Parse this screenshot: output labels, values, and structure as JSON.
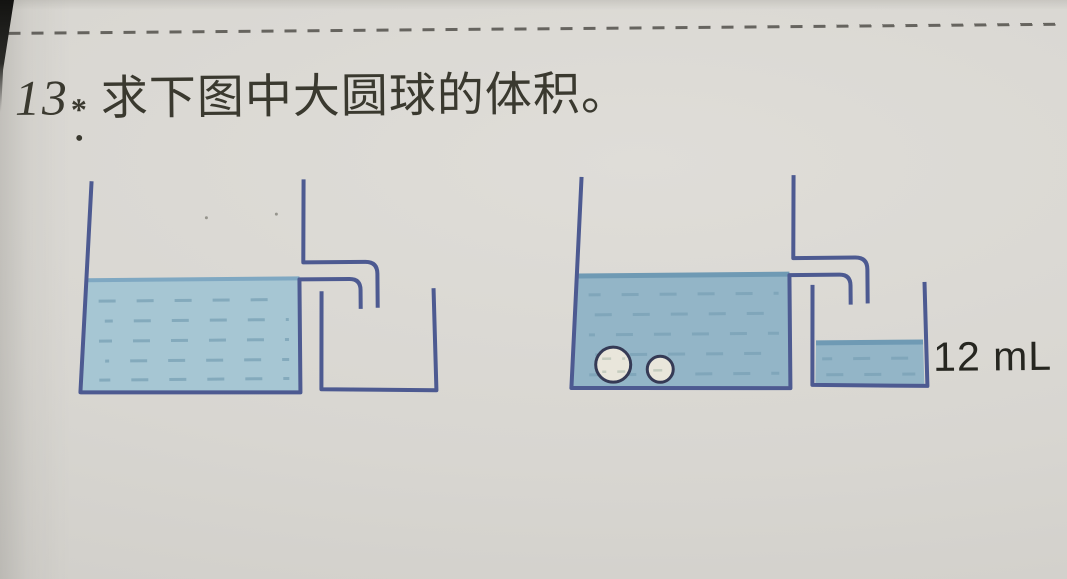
{
  "problem": {
    "number": "13",
    "star": "*",
    "dot": ".",
    "text": "求下图中大圆球的体积。"
  },
  "figure": {
    "beaker_label": "12 mL",
    "diagrams": [
      {
        "name": "before",
        "vessel": "overflow can filled with water to spout level",
        "spheres": 0,
        "catch_beaker": "empty"
      },
      {
        "name": "after",
        "vessel": "overflow can with large and small sphere submerged at bottom",
        "spheres": 2,
        "catch_beaker": "contains overflowed water labeled 12 mL"
      }
    ],
    "colors": {
      "outline": "#4d5a91",
      "water_left": "#a6c6d3",
      "water_right": "#93b5c7",
      "water_edge": "#7fa8c2",
      "water_edge_dark": "#6f9ab4",
      "water_dash": "#7ca2b6",
      "sphere_fill": "#e9e6db",
      "sphere_stroke": "#353a55",
      "sphere_dash": "#bcc6b8",
      "label_text": "#262620",
      "title_text": "#3a392f",
      "dash_line": "#514f4a"
    }
  }
}
